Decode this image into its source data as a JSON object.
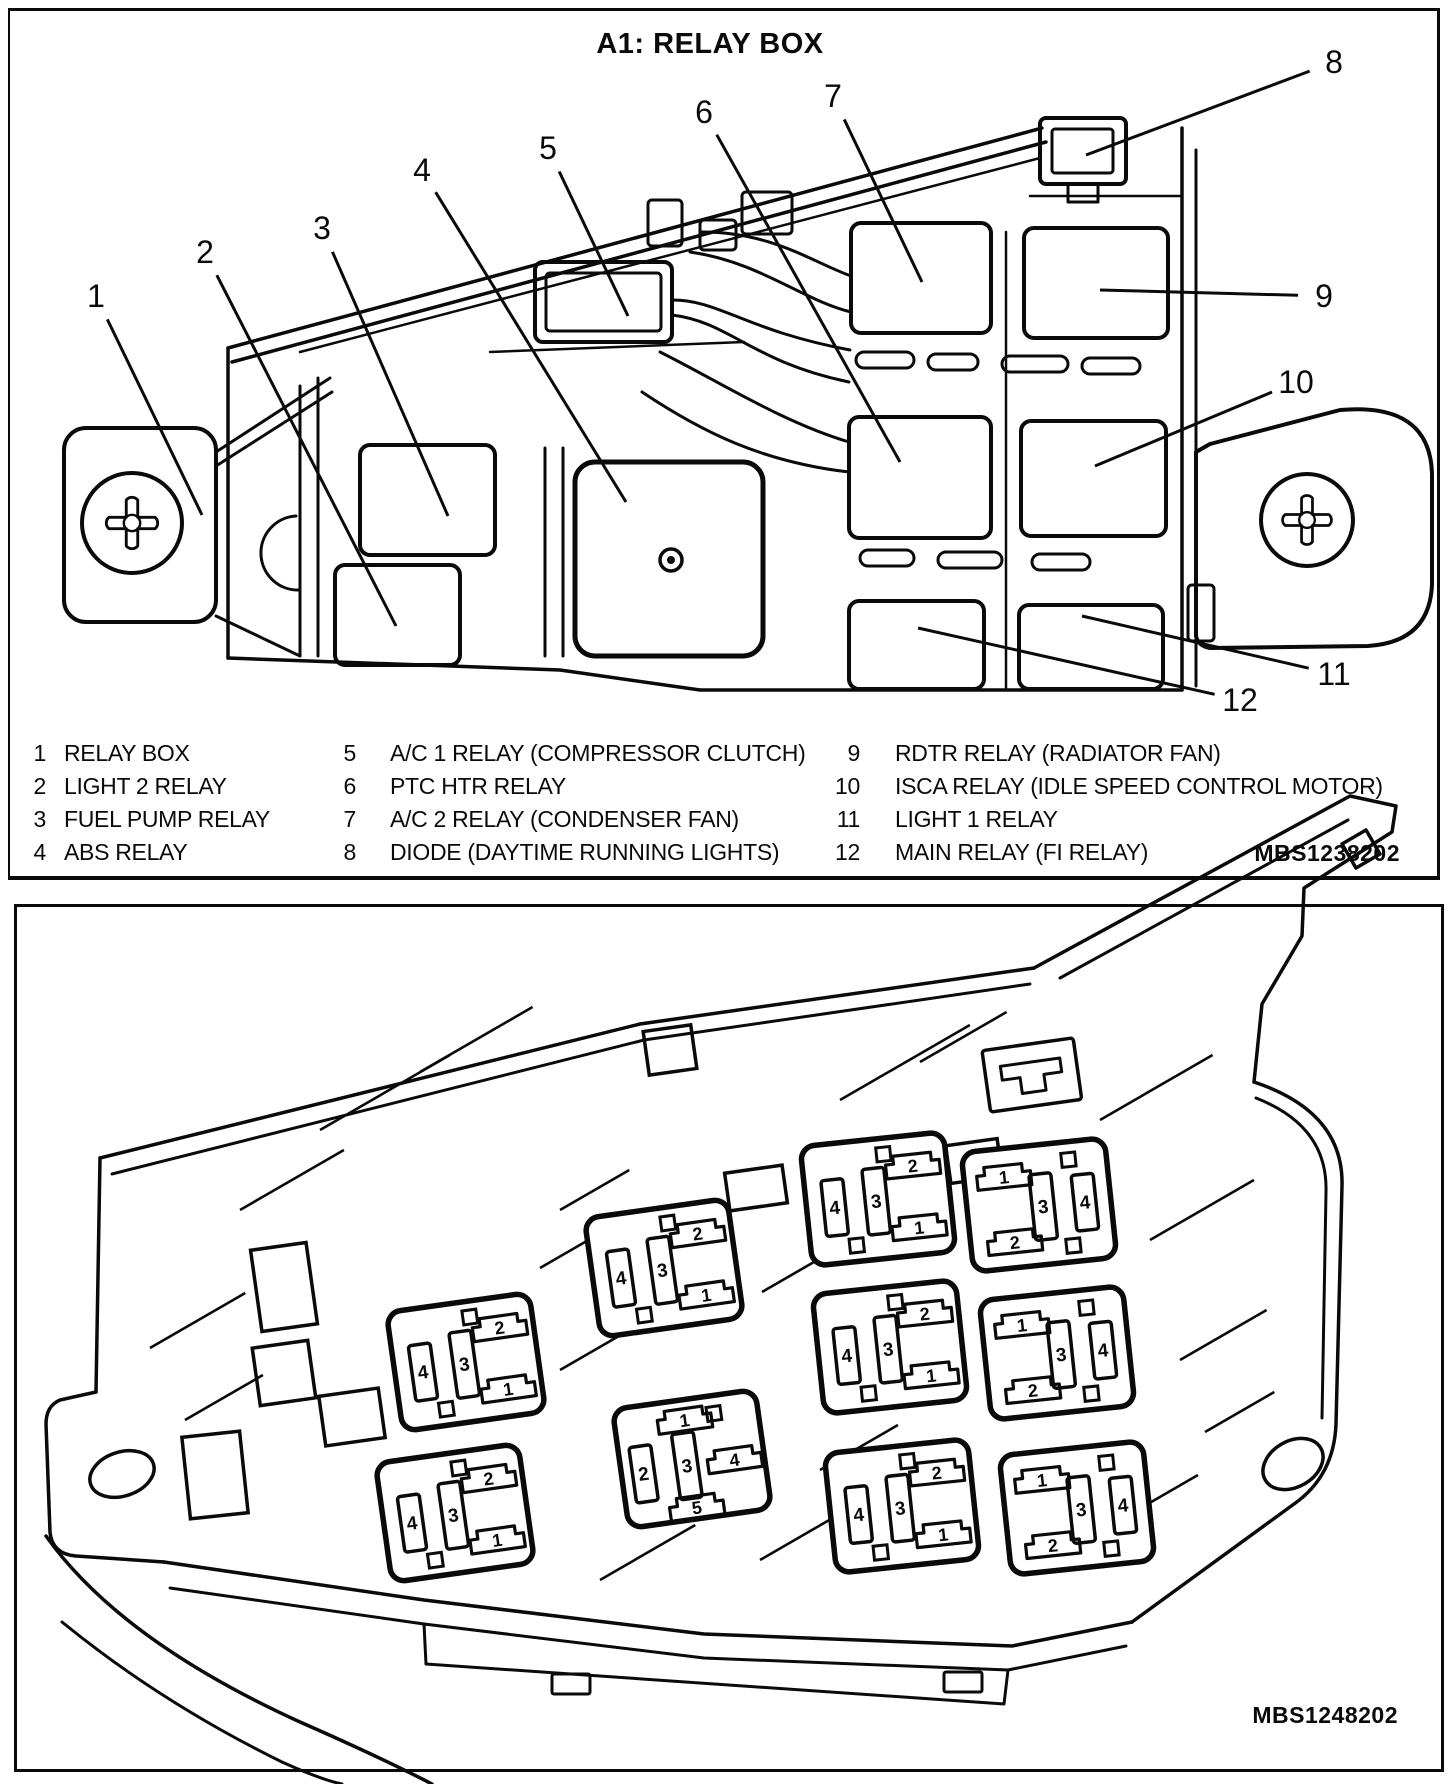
{
  "panel_top": {
    "title": "A1: RELAY BOX",
    "figure_code": "MBS1238202",
    "callouts": [
      {
        "n": "1",
        "x": 96,
        "y": 296,
        "tx": 202,
        "ty": 515
      },
      {
        "n": "2",
        "x": 205,
        "y": 252,
        "tx": 396,
        "ty": 626
      },
      {
        "n": "3",
        "x": 322,
        "y": 228,
        "tx": 448,
        "ty": 516
      },
      {
        "n": "4",
        "x": 422,
        "y": 170,
        "tx": 626,
        "ty": 502
      },
      {
        "n": "5",
        "x": 548,
        "y": 148,
        "tx": 628,
        "ty": 316
      },
      {
        "n": "6",
        "x": 704,
        "y": 112,
        "tx": 900,
        "ty": 462
      },
      {
        "n": "7",
        "x": 833,
        "y": 96,
        "tx": 922,
        "ty": 282
      },
      {
        "n": "8",
        "x": 1334,
        "y": 62,
        "tx": 1086,
        "ty": 155
      },
      {
        "n": "9",
        "x": 1324,
        "y": 296,
        "tx": 1100,
        "ty": 290
      },
      {
        "n": "10",
        "x": 1296,
        "y": 382,
        "tx": 1095,
        "ty": 466
      },
      {
        "n": "11",
        "x": 1334,
        "y": 674,
        "tx": 1082,
        "ty": 616
      },
      {
        "n": "12",
        "x": 1240,
        "y": 700,
        "tx": 918,
        "ty": 628
      }
    ],
    "legend_columns": [
      {
        "num_x": 22,
        "num_w": 24,
        "label_x": 64,
        "items": [
          {
            "num": "1",
            "label": "RELAY BOX"
          },
          {
            "num": "2",
            "label": "LIGHT 2 RELAY"
          },
          {
            "num": "3",
            "label": "FUEL PUMP RELAY"
          },
          {
            "num": "4",
            "label": "ABS RELAY"
          }
        ]
      },
      {
        "num_x": 332,
        "num_w": 24,
        "label_x": 390,
        "items": [
          {
            "num": "5",
            "label": "A/C 1 RELAY (COMPRESSOR CLUTCH)"
          },
          {
            "num": "6",
            "label": "PTC HTR RELAY"
          },
          {
            "num": "7",
            "label": "A/C 2 RELAY (CONDENSER FAN)"
          },
          {
            "num": "8",
            "label": "DIODE (DAYTIME RUNNING LIGHTS)"
          }
        ]
      },
      {
        "num_x": 818,
        "num_w": 42,
        "label_x": 895,
        "items": [
          {
            "num": "9",
            "label": "RDTR RELAY (RADIATOR FAN)"
          },
          {
            "num": "10",
            "label": "ISCA RELAY (IDLE SPEED CONTROL MOTOR)"
          },
          {
            "num": "11",
            "label": "LIGHT 1 RELAY"
          },
          {
            "num": "12",
            "label": "MAIN RELAY (FI RELAY)"
          }
        ]
      }
    ],
    "legend_row_y": [
      740,
      773,
      806,
      839
    ]
  },
  "panel_bottom": {
    "figure_code": "MBS1248202",
    "pin_styles": {
      "A": [
        {
          "t": "v",
          "x": -44,
          "y": 4,
          "h": 56,
          "n": "4"
        },
        {
          "t": "v",
          "x": -2,
          "y": 2,
          "h": 66,
          "n": "3"
        },
        {
          "t": "b",
          "x": 38,
          "y": -30,
          "n": "2"
        },
        {
          "t": "b",
          "x": 38,
          "y": 32,
          "n": "1"
        },
        {
          "t": "s",
          "x": 10,
          "y": -44
        },
        {
          "t": "s",
          "x": -26,
          "y": 44
        }
      ],
      "B": [
        {
          "t": "b",
          "x": -32,
          "y": -32,
          "n": "1"
        },
        {
          "t": "v",
          "x": 4,
          "y": 2,
          "h": 66,
          "n": "3"
        },
        {
          "t": "v",
          "x": 46,
          "y": 2,
          "h": 56,
          "n": "4"
        },
        {
          "t": "b",
          "x": -28,
          "y": 34,
          "n": "2"
        },
        {
          "t": "s",
          "x": 34,
          "y": -42
        },
        {
          "t": "s",
          "x": 30,
          "y": 44
        }
      ],
      "C": [
        {
          "t": "b",
          "x": -2,
          "y": -40,
          "n": "1"
        },
        {
          "t": "v",
          "x": -50,
          "y": 8,
          "h": 56,
          "n": "2"
        },
        {
          "t": "v",
          "x": -6,
          "y": 6,
          "h": 66,
          "n": "3"
        },
        {
          "t": "b",
          "x": 42,
          "y": 6,
          "n": "4"
        },
        {
          "t": "b",
          "x": -2,
          "y": 48,
          "n": "5"
        },
        {
          "t": "s",
          "x": 28,
          "y": -42
        }
      ]
    },
    "relays": [
      {
        "x": 664,
        "y": 1268,
        "rot": -8,
        "style": "A"
      },
      {
        "x": 466,
        "y": 1362,
        "rot": -8,
        "style": "A"
      },
      {
        "x": 455,
        "y": 1513,
        "rot": -8,
        "style": "A"
      },
      {
        "x": 692,
        "y": 1459,
        "rot": -8,
        "style": "C"
      },
      {
        "x": 878,
        "y": 1199,
        "rot": -6,
        "style": "A"
      },
      {
        "x": 1039,
        "y": 1205,
        "rot": -6,
        "style": "B"
      },
      {
        "x": 890,
        "y": 1347,
        "rot": -6,
        "style": "A"
      },
      {
        "x": 1057,
        "y": 1353,
        "rot": -6,
        "style": "B"
      },
      {
        "x": 902,
        "y": 1506,
        "rot": -6,
        "style": "A"
      },
      {
        "x": 1077,
        "y": 1508,
        "rot": -6,
        "style": "B"
      }
    ]
  }
}
